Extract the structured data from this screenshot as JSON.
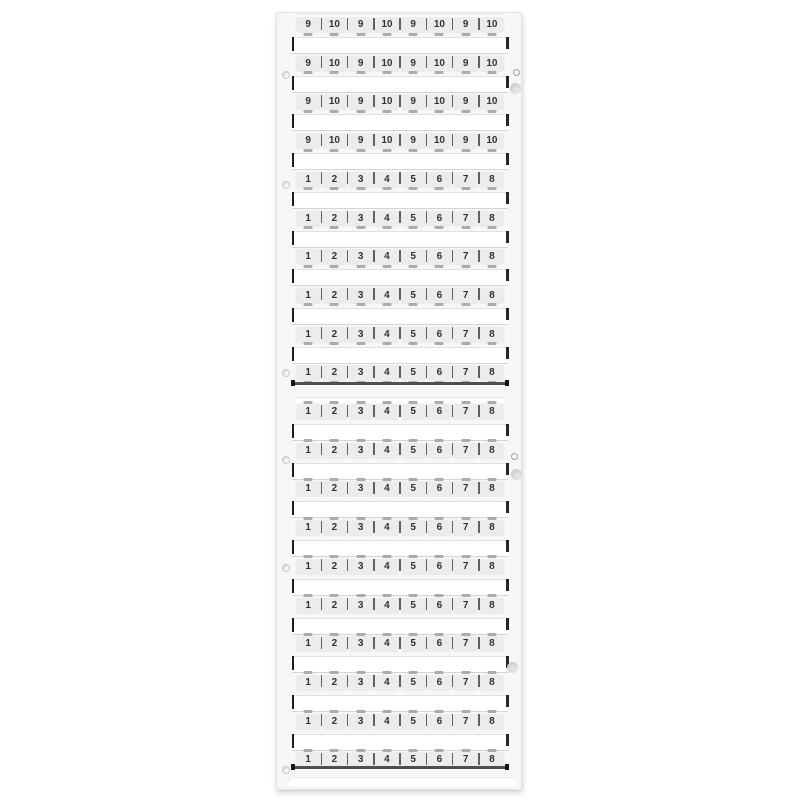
{
  "card": {
    "marker_rows": [
      {
        "labels": [
          "9",
          "10",
          "9",
          "10",
          "9",
          "10",
          "9",
          "10"
        ]
      },
      {
        "labels": [
          "9",
          "10",
          "9",
          "10",
          "9",
          "10",
          "9",
          "10"
        ]
      },
      {
        "labels": [
          "9",
          "10",
          "9",
          "10",
          "9",
          "10",
          "9",
          "10"
        ]
      },
      {
        "labels": [
          "9",
          "10",
          "9",
          "10",
          "9",
          "10",
          "9",
          "10"
        ]
      },
      {
        "labels": [
          "1",
          "2",
          "3",
          "4",
          "5",
          "6",
          "7",
          "8"
        ]
      },
      {
        "labels": [
          "1",
          "2",
          "3",
          "4",
          "5",
          "6",
          "7",
          "8"
        ]
      },
      {
        "labels": [
          "1",
          "2",
          "3",
          "4",
          "5",
          "6",
          "7",
          "8"
        ]
      },
      {
        "labels": [
          "1",
          "2",
          "3",
          "4",
          "5",
          "6",
          "7",
          "8"
        ]
      },
      {
        "labels": [
          "1",
          "2",
          "3",
          "4",
          "5",
          "6",
          "7",
          "8"
        ]
      },
      {
        "labels": [
          "1",
          "2",
          "3",
          "4",
          "5",
          "6",
          "7",
          "8"
        ]
      },
      {
        "labels": [
          "1",
          "2",
          "3",
          "4",
          "5",
          "6",
          "7",
          "8"
        ]
      },
      {
        "labels": [
          "1",
          "2",
          "3",
          "4",
          "5",
          "6",
          "7",
          "8"
        ]
      },
      {
        "labels": [
          "1",
          "2",
          "3",
          "4",
          "5",
          "6",
          "7",
          "8"
        ]
      },
      {
        "labels": [
          "1",
          "2",
          "3",
          "4",
          "5",
          "6",
          "7",
          "8"
        ]
      },
      {
        "labels": [
          "1",
          "2",
          "3",
          "4",
          "5",
          "6",
          "7",
          "8"
        ]
      },
      {
        "labels": [
          "1",
          "2",
          "3",
          "4",
          "5",
          "6",
          "7",
          "8"
        ]
      },
      {
        "labels": [
          "1",
          "2",
          "3",
          "4",
          "5",
          "6",
          "7",
          "8"
        ]
      },
      {
        "labels": [
          "1",
          "2",
          "3",
          "4",
          "5",
          "6",
          "7",
          "8"
        ]
      },
      {
        "labels": [
          "1",
          "2",
          "3",
          "4",
          "5",
          "6",
          "7",
          "8"
        ]
      },
      {
        "labels": [
          "1",
          "2",
          "3",
          "4",
          "5",
          "6",
          "7",
          "8"
        ]
      }
    ]
  },
  "colors": {
    "card_face": "#f7f7f7",
    "tag_fill": "#ececec",
    "window_fill": "#ffffff",
    "separator": "#606060",
    "digit": "#333333",
    "edge_dark": "#1f1f1f",
    "bridge": "#ababab"
  }
}
